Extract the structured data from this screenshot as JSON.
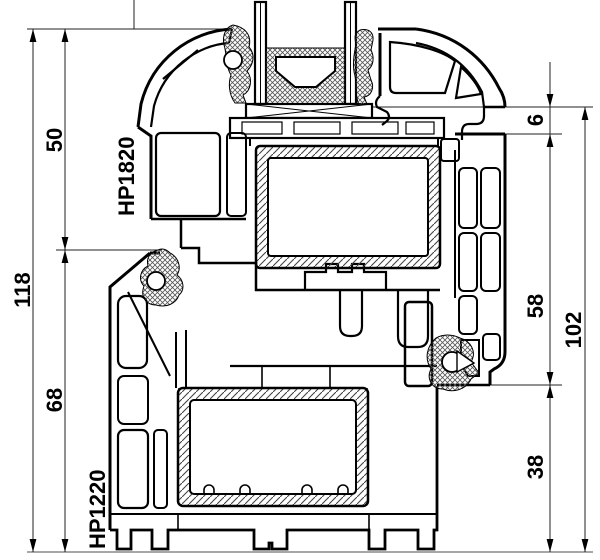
{
  "drawing": {
    "type": "technical-cross-section",
    "dimensions_left": {
      "upper": "50",
      "total": "118",
      "lower": "68"
    },
    "dimensions_right": {
      "gap": "6",
      "upper": "58",
      "total": "102",
      "lower": "38"
    },
    "profile_labels": {
      "sash": "HP1820",
      "frame": "HP1220"
    },
    "colors": {
      "line": "#000000",
      "dimension": "#222222",
      "baseline": "#8a8a8a",
      "background": "#ffffff"
    }
  }
}
